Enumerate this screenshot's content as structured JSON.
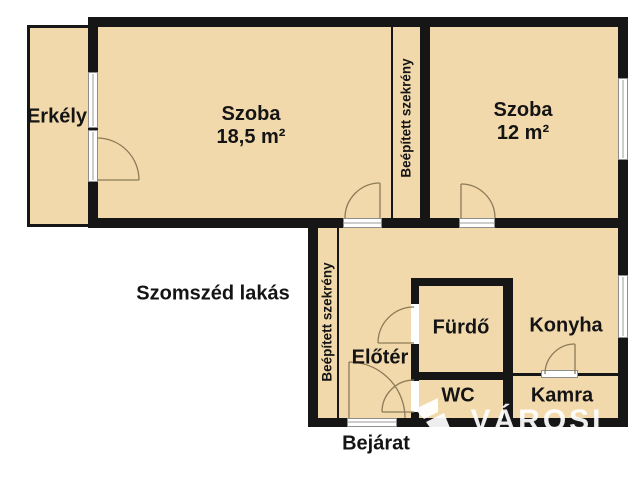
{
  "colors": {
    "wall": "#161616",
    "room_fill": "#f1d9ac",
    "background": "#ffffff",
    "door_arc": "#8d7b57",
    "window_frame": "#8e8e8e",
    "watermark": "#ffffff"
  },
  "rooms": {
    "erkely": {
      "name": "Erkély"
    },
    "szoba_large": {
      "name": "Szoba",
      "area": "18,5 m²"
    },
    "szoba_small": {
      "name": "Szoba",
      "area": "12 m²"
    },
    "closet_upper": {
      "name": "Beépített szekrény"
    },
    "closet_lower": {
      "name": "Beépített szekrény"
    },
    "eloter": {
      "name": "Előtér"
    },
    "furdo": {
      "name": "Fürdő"
    },
    "konyha": {
      "name": "Konyha"
    },
    "wc": {
      "name": "WC"
    },
    "kamra": {
      "name": "Kamra"
    }
  },
  "annotations": {
    "neighbor_flat": "Szomszéd lakás",
    "entrance": "Bejárat"
  },
  "watermark": {
    "text": "VÁROSI"
  }
}
